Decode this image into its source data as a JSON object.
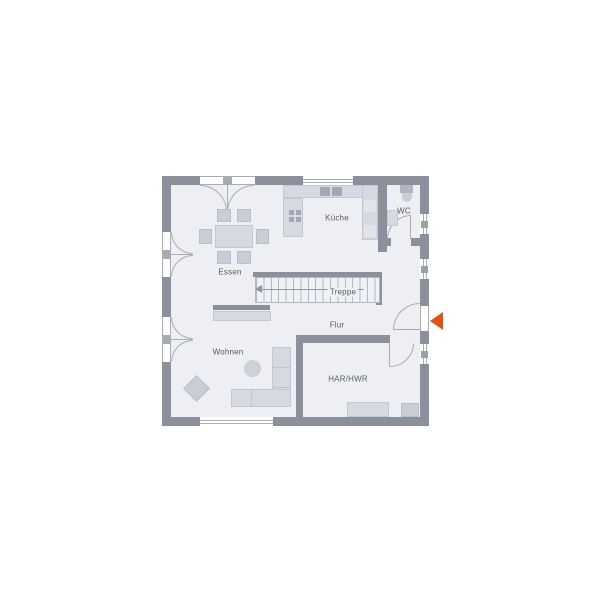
{
  "floorplan": {
    "type": "residential ground-floor plan",
    "rooms": {
      "essen": "Essen",
      "kueche": "Küche",
      "wc": "WC",
      "treppe": "Treppe",
      "flur": "Flur",
      "wohnen": "Wohnen",
      "har": "HAR/HWR"
    },
    "markers": {
      "entrance_arrow": "orange triangle pointing at entrance door on right wall"
    },
    "colors": {
      "wall": "#8b909c",
      "floor": "#edeff3",
      "furniture": "#d6d9e1",
      "door_window_line": "#a8adb8",
      "entrance_arrow": "#e2520f",
      "label_text": "#565b66",
      "background": "#ffffff"
    }
  }
}
